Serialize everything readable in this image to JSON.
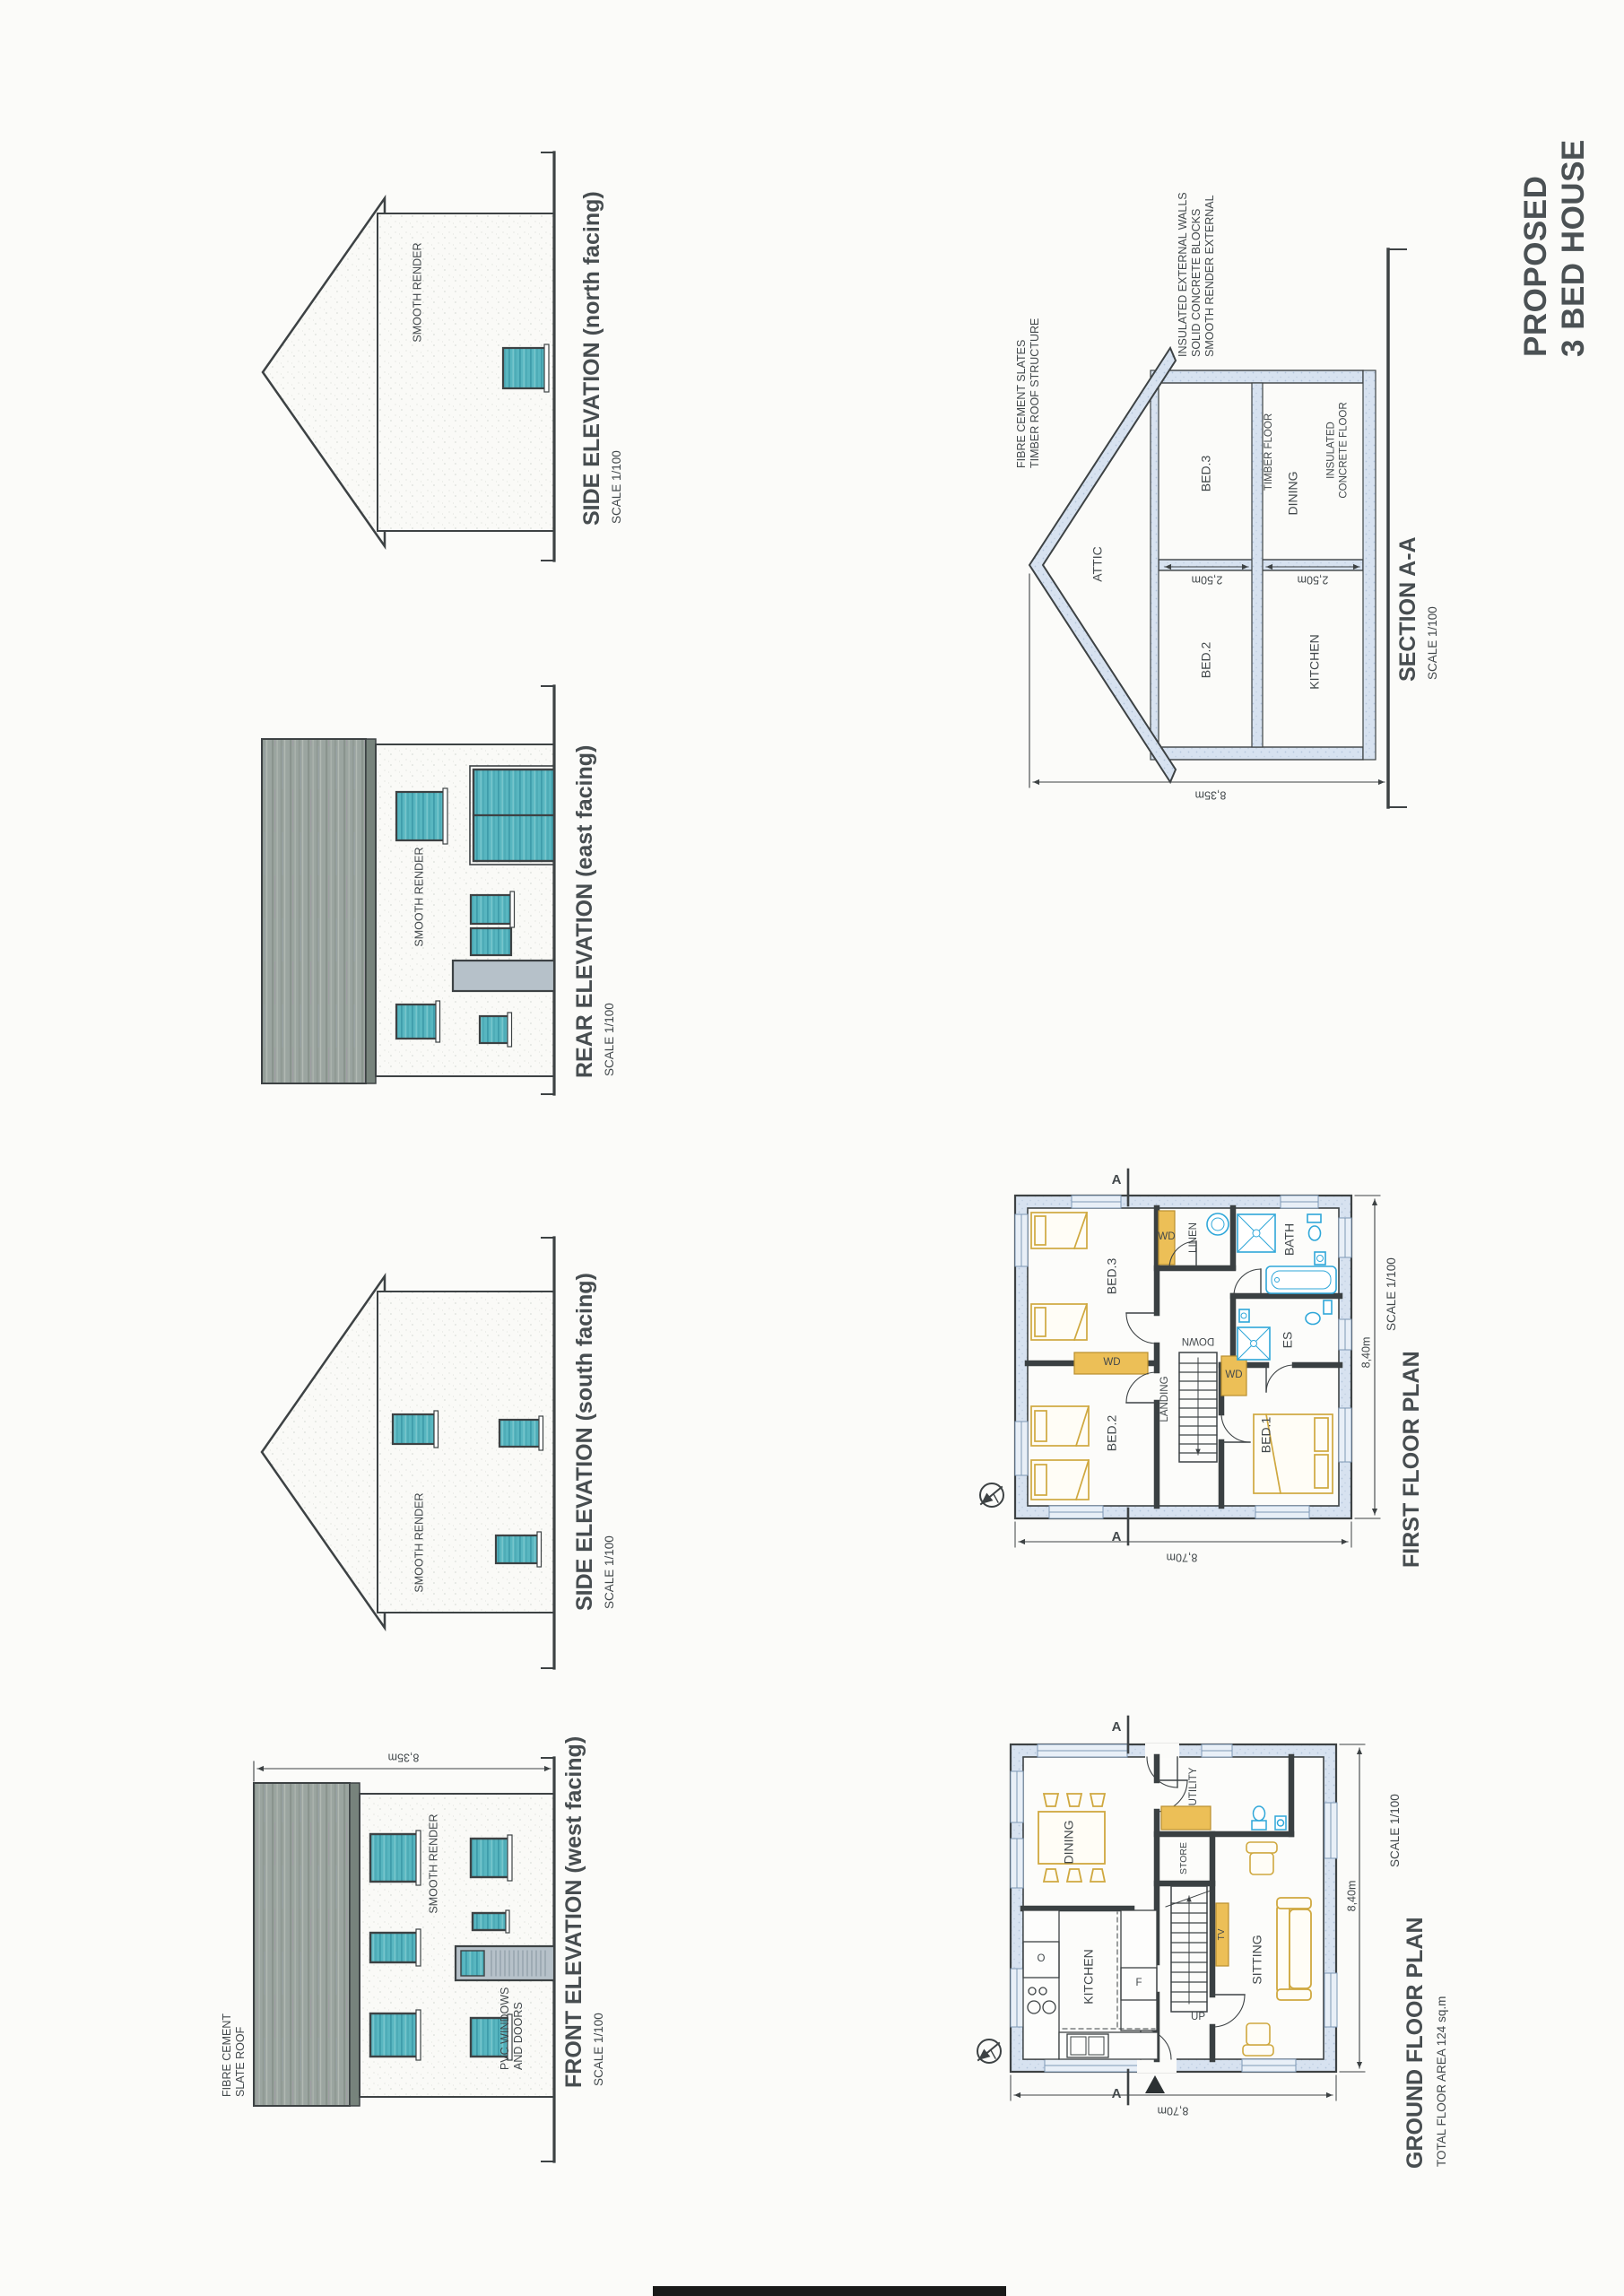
{
  "sheet": {
    "title_line1": "PROPOSED",
    "title_line2": "3 BED HOUSE"
  },
  "common": {
    "scale": "SCALE 1/100",
    "smooth_render": "SMOOTH RENDER",
    "section_marker": "A",
    "wardrobe": "WD"
  },
  "elevations": {
    "front": {
      "title": "FRONT ELEVATION  (west facing)",
      "roof_note": "FIBRE CEMENT\nSLATE ROOF",
      "pvc_note": "PVC WINDOWS\nAND DOORS",
      "height_dim": "8,35m"
    },
    "south": {
      "title": "SIDE ELEVATION  (south facing)"
    },
    "rear": {
      "title": "REAR ELEVATION  (east facing)"
    },
    "north": {
      "title": "SIDE ELEVATION  (north facing)"
    }
  },
  "section": {
    "title": "SECTION A-A",
    "rooms": {
      "attic": "ATTIC",
      "bed2": "BED.2",
      "bed3": "BED.3",
      "kitchen": "KITCHEN",
      "dining": "DINING"
    },
    "notes": {
      "roof": "FIBRE CEMENT SLATES\nTIMBER ROOF STRUCTURE",
      "wall": "INSULATED EXTERNAL WALLS\nSOLID CONCRETE BLOCKS\nSMOOTH RENDER EXTERNAL",
      "floor_first": "TIMBER FLOOR",
      "floor_ground": "INSULATED\nCONCRETE FLOOR"
    },
    "dims": {
      "storey": "2,50m",
      "height": "8,35m"
    }
  },
  "ground_floor": {
    "title": "GROUND FLOOR PLAN",
    "area": "TOTAL FLOOR AREA 124 sq.m",
    "rooms": {
      "dining": "DINING",
      "kitchen": "KITCHEN",
      "utility": "UTILITY",
      "store": "STORE",
      "sitting": "SITTING"
    },
    "labels": {
      "up": "UP",
      "tv": "TV",
      "fridge": "F",
      "oven": "O"
    },
    "dims": {
      "width": "8,40m",
      "depth": "8,70m"
    }
  },
  "first_floor": {
    "title": "FIRST FLOOR PLAN",
    "rooms": {
      "bed1": "BED.1",
      "bed2": "BED.2",
      "bed3": "BED.3",
      "bath": "BATH",
      "es": "ES",
      "linen": "LINEN",
      "landing": "LANDING"
    },
    "labels": {
      "down": "DOWN"
    },
    "dims": {
      "width": "8,40m",
      "depth": "8,70m"
    }
  },
  "colors": {
    "paper": "#fbfbf9",
    "ink": "#3d4244",
    "window_teal": "#58b6c0",
    "roof_grey": "#9ba5a0",
    "wall_hatch": "#d7e2f0",
    "furniture_yellow": "#ecbf57",
    "fixture_blue": "#2fa7d9",
    "text": "#42484b"
  }
}
